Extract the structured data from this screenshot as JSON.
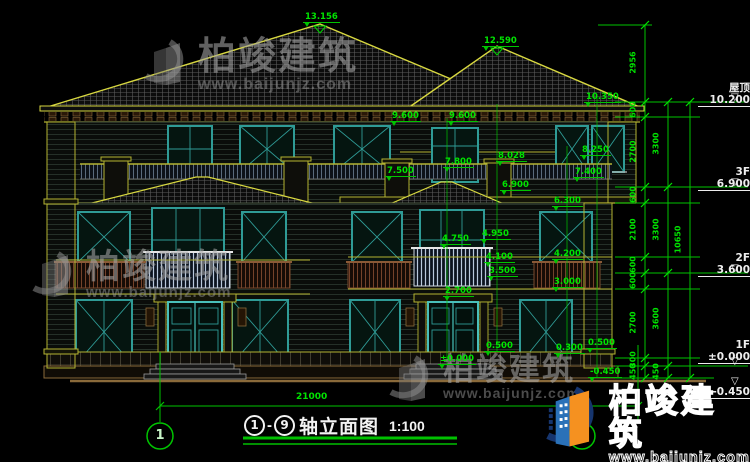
{
  "drawing": {
    "title": {
      "axis_from": "1",
      "axis_to": "9",
      "name": "轴立面图",
      "scale": "1:100"
    },
    "overall_width_dimension": "21000",
    "axis_bubbles": [
      {
        "label": "1",
        "x": 160,
        "y": 436
      },
      {
        "label": "9",
        "x": 582,
        "y": 436
      }
    ],
    "elevation_annotations": [
      {
        "text": "13.156",
        "x": 303,
        "y": 12
      },
      {
        "text": "12.590",
        "x": 482,
        "y": 36
      },
      {
        "text": "10.350",
        "x": 584,
        "y": 92
      },
      {
        "text": "9.600",
        "x": 390,
        "y": 111
      },
      {
        "text": "9.600",
        "x": 447,
        "y": 111
      },
      {
        "text": "8.250",
        "x": 580,
        "y": 145
      },
      {
        "text": "8.028",
        "x": 496,
        "y": 151
      },
      {
        "text": "7.800",
        "x": 443,
        "y": 157
      },
      {
        "text": "7.500",
        "x": 385,
        "y": 166
      },
      {
        "text": "7.400",
        "x": 573,
        "y": 167
      },
      {
        "text": "6.900",
        "x": 500,
        "y": 180
      },
      {
        "text": "6.300",
        "x": 552,
        "y": 196
      },
      {
        "text": "4.950",
        "x": 480,
        "y": 229
      },
      {
        "text": "4.750",
        "x": 440,
        "y": 234
      },
      {
        "text": "4.200",
        "x": 552,
        "y": 249
      },
      {
        "text": "4.100",
        "x": 484,
        "y": 252
      },
      {
        "text": "3.500",
        "x": 487,
        "y": 266
      },
      {
        "text": "3.000",
        "x": 552,
        "y": 277
      },
      {
        "text": "2.700",
        "x": 443,
        "y": 286
      },
      {
        "text": "0.500",
        "x": 484,
        "y": 341
      },
      {
        "text": "0.300",
        "x": 554,
        "y": 343
      },
      {
        "text": "0.500",
        "x": 586,
        "y": 338
      },
      {
        "text": "±0.000",
        "x": 438,
        "y": 354
      },
      {
        "text": "-0.450",
        "x": 588,
        "y": 367
      }
    ],
    "level_markers": [
      {
        "label": "屋顶",
        "value": "10.200",
        "x": 698,
        "y": 82,
        "tx": 731,
        "ty": 92
      },
      {
        "label": "3F",
        "value": "6.900",
        "x": 698,
        "y": 166,
        "tx": 731,
        "ty": 177
      },
      {
        "label": "2F",
        "value": "3.600",
        "x": 698,
        "y": 252,
        "tx": 731,
        "ty": 263
      },
      {
        "label": "1F",
        "value": "±0.000",
        "x": 698,
        "y": 339,
        "tx": 731,
        "ty": 356
      },
      {
        "label": "",
        "value": "-0.450",
        "x": 698,
        "y": 386,
        "tx": 731,
        "ty": 376
      }
    ],
    "dimension_chains": [
      {
        "x": 645,
        "top": 25,
        "bottom": 378,
        "labels": [
          {
            "v": "2956",
            "y": 63
          },
          {
            "v": "600",
            "y": 110
          },
          {
            "v": "2700",
            "y": 152
          },
          {
            "v": "600",
            "y": 195
          },
          {
            "v": "2100",
            "y": 230
          },
          {
            "v": "600",
            "y": 265
          },
          {
            "v": "600",
            "y": 281
          },
          {
            "v": "2700",
            "y": 323
          },
          {
            "v": "300",
            "y": 360
          },
          {
            "v": "450",
            "y": 372
          }
        ],
        "ticks": [
          25,
          102,
          117,
          187,
          203,
          257,
          273,
          289,
          358,
          366,
          378
        ]
      },
      {
        "x": 668,
        "top": 102,
        "bottom": 378,
        "labels": [
          {
            "v": "3300",
            "y": 144
          },
          {
            "v": "3300",
            "y": 230
          },
          {
            "v": "3600",
            "y": 319
          },
          {
            "v": "450",
            "y": 372
          }
        ],
        "ticks": [
          102,
          187,
          273,
          366,
          378
        ]
      },
      {
        "x": 690,
        "top": 102,
        "bottom": 378,
        "labels": [
          {
            "v": "10650",
            "y": 240
          }
        ],
        "ticks": [
          102,
          378
        ]
      }
    ],
    "watermarks": [
      {
        "text": "柏竣建筑",
        "url": "www.baijunjz.com",
        "x": 140,
        "y": 38,
        "size": 38,
        "usize": 16
      },
      {
        "text": "柏竣建筑",
        "url": "www.baijunjz.com",
        "x": 28,
        "y": 250,
        "size": 34,
        "usize": 15
      },
      {
        "text": "柏竣建筑",
        "url": "www.baijunjz.com",
        "x": 385,
        "y": 354,
        "size": 31,
        "usize": 14
      }
    ],
    "logo": {
      "text": "柏竣建筑",
      "url": "www.baijunjz.com"
    },
    "colors": {
      "background": "#000000",
      "dimension_green": "#00e400",
      "trim_yellow": "#b4b432",
      "ridge_yellow": "#d8d840",
      "window_teal": "#2f9b96",
      "rail_brown": "#7a4a2e",
      "ground_tan": "#8a6a3a",
      "logo_blue": "#16356e",
      "logo_orange": "#f59120",
      "logo_sky": "#2a71b8"
    }
  }
}
